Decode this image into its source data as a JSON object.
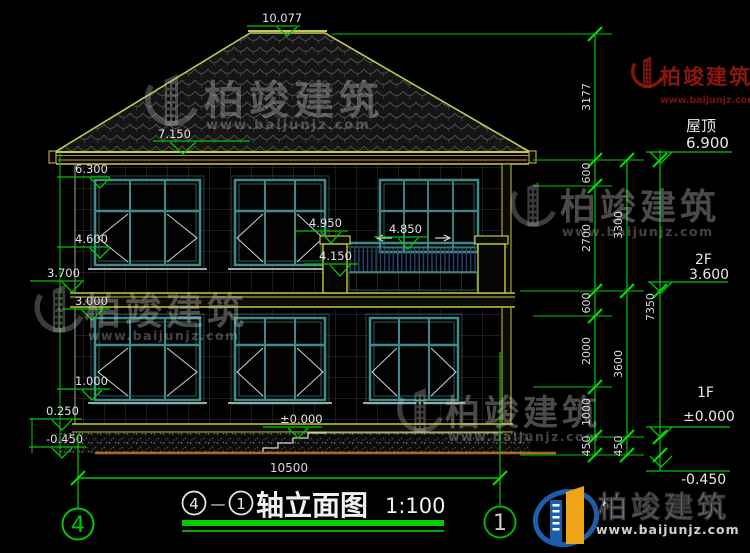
{
  "levels": {
    "ridge": "10.077",
    "roof": "7.150",
    "eave": "6.300",
    "win2_top": "4.600",
    "band2": "3.700",
    "floor2": "3.000",
    "win1_sill": "1.000",
    "plinth": "0.250",
    "ground": "-0.450",
    "entry": "±0.000",
    "balcony_rail": "4.950",
    "balcony_window": "4.850",
    "balcony_floor": "4.150"
  },
  "dims": {
    "col1": [
      "3177",
      "600",
      "2700",
      "600",
      "2000",
      "1000",
      "450"
    ],
    "col2": [
      "3300",
      "3600",
      "450"
    ],
    "col3": [
      "7350"
    ],
    "total_width": "10500"
  },
  "floors": {
    "roof_label": "屋顶",
    "roof_value": "6.900",
    "f2_label": "2F",
    "f2_value": "3.600",
    "f1_label": "1F",
    "f1_value": "±0.000",
    "base_value": "-0.450"
  },
  "axis": {
    "left": "4",
    "right": "1"
  },
  "title": {
    "axis_left": "4",
    "separator": "—",
    "axis_right": "1",
    "text": "轴立面图",
    "scale": "1:100"
  },
  "watermark": {
    "brand": "柏竣建筑",
    "url": "www.baijunjz.com"
  },
  "colors": {
    "dimension_green": "#00c800",
    "outline_yellow": "#c8c832",
    "window_teal": "#3f8b8b",
    "ground_orange": "#b06a1e",
    "logo_blue": "#1c5fa8",
    "logo_orange": "#f0a418",
    "watermark_red": "#96190e"
  }
}
